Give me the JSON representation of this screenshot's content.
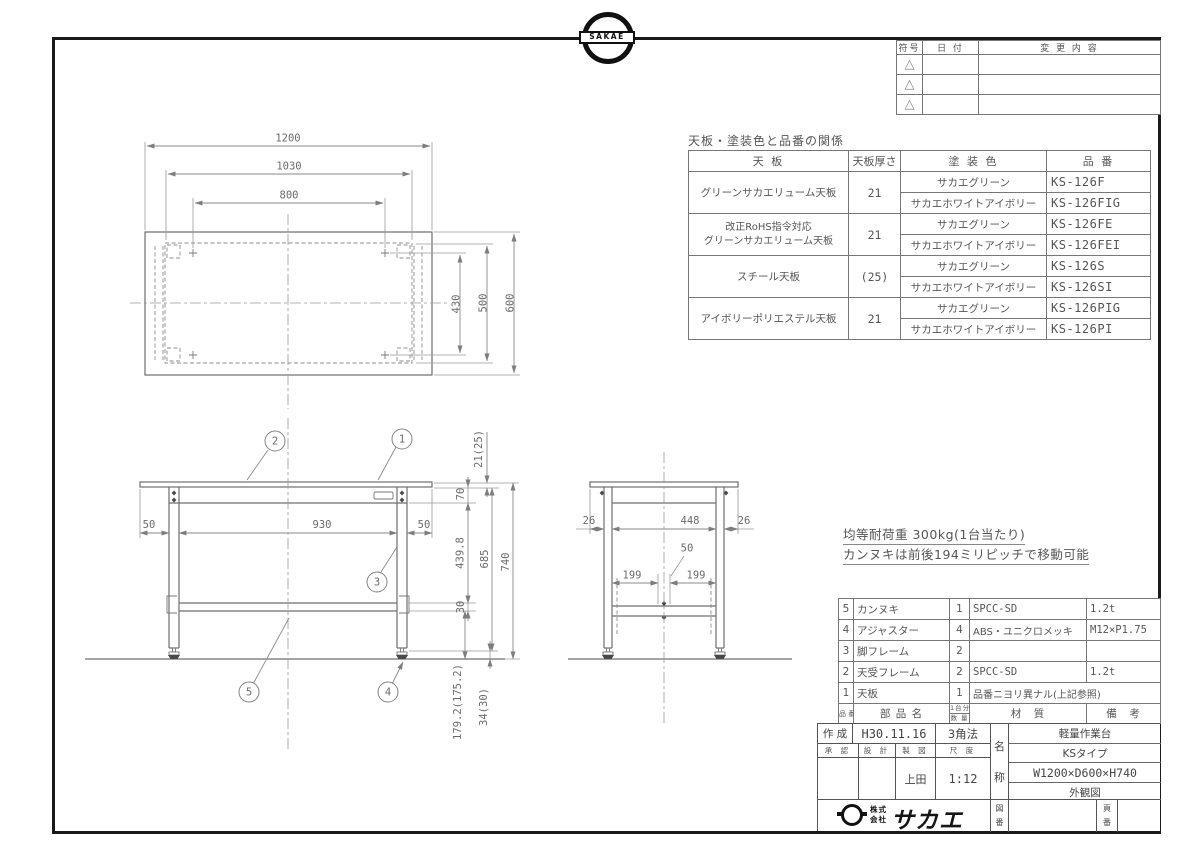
{
  "colors": {
    "sheet_border": "#1a1a1a",
    "line": "#8a8a8a",
    "text": "#555555"
  },
  "sheet": {
    "top_logo_text": "SAKAE"
  },
  "revision_table": {
    "col_mark": "符号",
    "col_date": "日 付",
    "col_change": "変 更 内 容",
    "triangle": "△"
  },
  "spec_table": {
    "title": "天板・塗装色と品番の関係",
    "col_top": "天 板",
    "col_thickness": "天板厚さ",
    "col_color": "塗 装 色",
    "col_number": "品 番",
    "rows": [
      {
        "top_line1": "グリーンサカエリューム天板",
        "top_line2": "",
        "thickness": "21",
        "variants": [
          {
            "color": "サカエグリーン",
            "number": "KS-126F"
          },
          {
            "color": "サカエホワイトアイボリー",
            "number": "KS-126FIG"
          }
        ]
      },
      {
        "top_line1": "改正RoHS指令対応",
        "top_line2": "グリーンサカエリューム天板",
        "thickness": "21",
        "variants": [
          {
            "color": "サカエグリーン",
            "number": "KS-126FE"
          },
          {
            "color": "サカエホワイトアイボリー",
            "number": "KS-126FEI"
          }
        ]
      },
      {
        "top_line1": "スチール天板",
        "top_line2": "",
        "thickness": "(25)",
        "variants": [
          {
            "color": "サカエグリーン",
            "number": "KS-126S"
          },
          {
            "color": "サカエホワイトアイボリー",
            "number": "KS-126SI"
          }
        ]
      },
      {
        "top_line1": "アイボリーポリエステル天板",
        "top_line2": "",
        "thickness": "21",
        "variants": [
          {
            "color": "サカエグリーン",
            "number": "KS-126PIG"
          },
          {
            "color": "サカエホワイトアイボリー",
            "number": "KS-126PI"
          }
        ]
      }
    ]
  },
  "notes": {
    "load": "均等耐荷重 300kg(1台当たり)",
    "pitch": "カンヌキは前後194ミリピッチで移動可能"
  },
  "parts_table": {
    "header": {
      "no": "品 番",
      "name": "部 品 名",
      "qty_top": "1台分",
      "qty_bottom": "数 量",
      "material": "材　質",
      "remarks": "備　考"
    },
    "rows": [
      {
        "no": "5",
        "name": "カンヌキ",
        "qty": "1",
        "material": "SPCC-SD",
        "remarks": "1.2t"
      },
      {
        "no": "4",
        "name": "アジャスター",
        "qty": "4",
        "material": "ABS・ユニクロメッキ",
        "remarks": "M12×P1.75"
      },
      {
        "no": "3",
        "name": "脚フレーム",
        "qty": "2",
        "material": "",
        "remarks": ""
      },
      {
        "no": "2",
        "name": "天受フレーム",
        "qty": "2",
        "material": "SPCC-SD",
        "remarks": "1.2t"
      },
      {
        "no": "1",
        "name": "天板",
        "qty": "1",
        "material": "品番ニヨリ異ナル(上記参照)",
        "remarks": ""
      }
    ]
  },
  "title_block": {
    "created_label": "作 成",
    "created_date": "H30.11.16",
    "projection": "3角法",
    "approved_label": "承 認",
    "design_label": "設 計",
    "draft_label": "製 図",
    "scale_label": "尺 度",
    "drafter": "上田",
    "scale": "1:12",
    "name_char1": "名",
    "name_char2": "称",
    "product_line1": "軽量作業台",
    "product_line2": "KSタイプ",
    "product_line3": "W1200×D600×H740",
    "product_line4": "外観図",
    "company_line1": "株式",
    "company_line2": "会社",
    "company_name": "サカエ",
    "drawing_no_char1": "図",
    "drawing_no_char2": "番",
    "page_no_char1": "頁",
    "page_no_char2": "番"
  },
  "dims": {
    "top_view": {
      "overall_width": "1200",
      "frame_width": "1030",
      "leg_pitch": "800",
      "inner_depth": "430",
      "frame_depth": "500",
      "overall_depth": "600"
    },
    "front_view": {
      "left_overhang": "50",
      "leg_span": "930",
      "right_overhang": "50",
      "top_thickness": "21(25)",
      "frame_height": "70",
      "upper_leg": "439.8",
      "under_top_height": "685",
      "overall_height": "740",
      "bar_thickness": "30",
      "foot_height": "34(30)",
      "lower_leg": "179.2(175.2)"
    },
    "side_view": {
      "left_overhang": "26",
      "depth_span": "448",
      "right_overhang": "26",
      "bar_gap": "50",
      "pitch_left": "199",
      "pitch_right": "199"
    }
  },
  "balloons": {
    "b1": "1",
    "b2": "2",
    "b3": "3",
    "b4": "4",
    "b5": "5"
  }
}
